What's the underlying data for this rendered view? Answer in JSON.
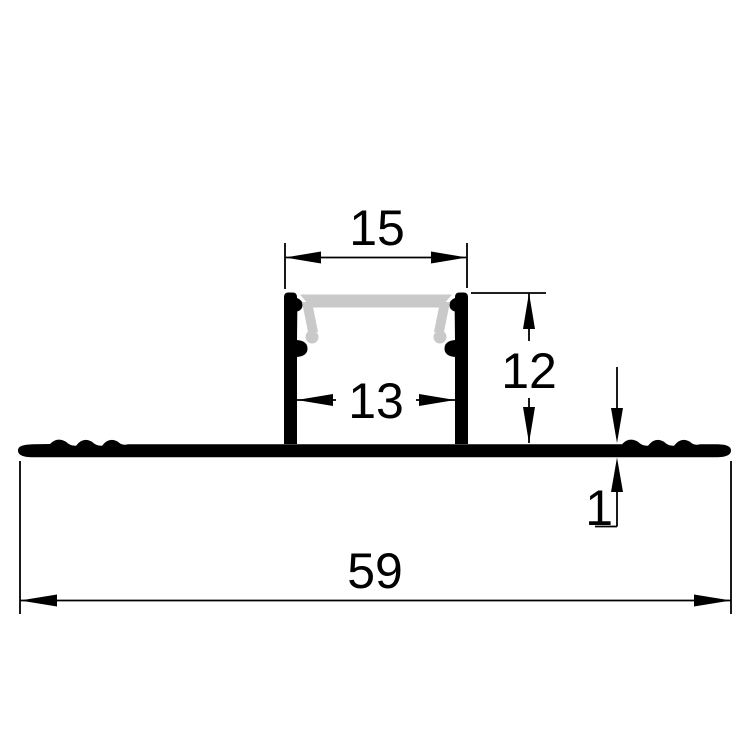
{
  "drawing": {
    "kind": "technical-cross-section",
    "subject": "recessed LED aluminium profile with drywall flange and diffuser",
    "dimensions": {
      "top_opening": "15",
      "inner_width": "13",
      "height": "12",
      "flange_thickness": "1",
      "overall_width": "59"
    },
    "colors": {
      "background": "#FFFFFF",
      "line": "#000000",
      "profile_fill": "#000000",
      "diffuser_fill": "#C9C9C9"
    }
  }
}
